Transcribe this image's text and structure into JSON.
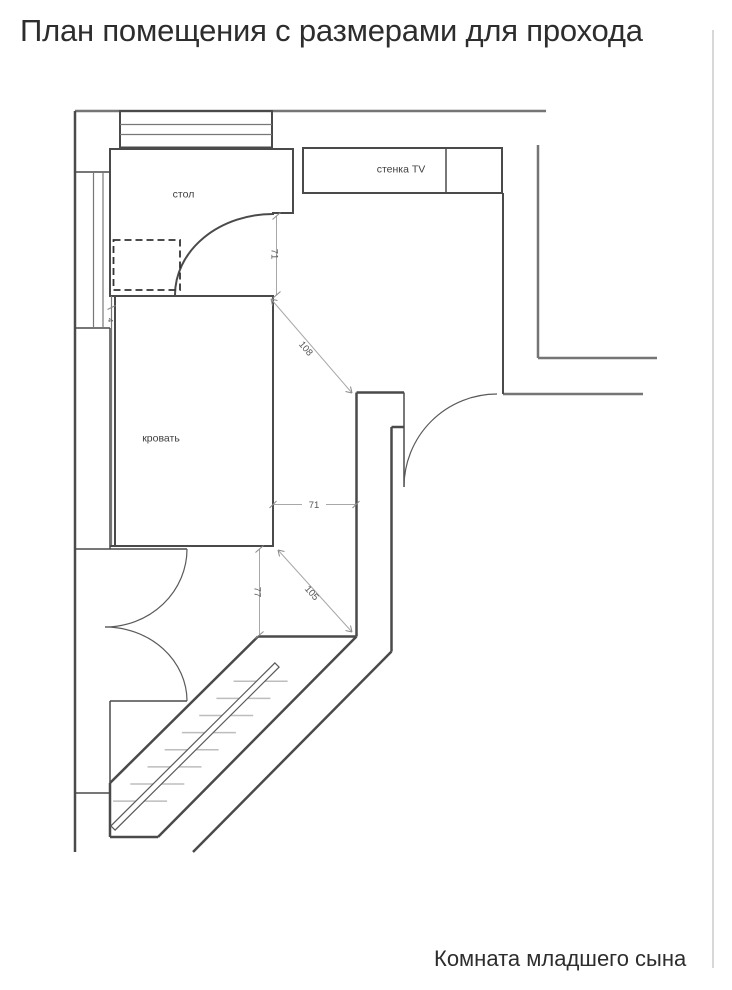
{
  "title": "План помещения с размерами для прохода",
  "caption": "Комната младшего сына",
  "labels": {
    "desk": "стол",
    "tv_unit": "стенка TV",
    "bed": "кровать"
  },
  "dimensions": {
    "desk_to_bed_vertical": "71",
    "bed_corner_to_door_wall_diagonal": "108",
    "bed_to_corridor_wall_horizontal": "71",
    "bed_to_bay_window_vertical": "77",
    "bed_corner_to_corridor_corner_diagonal": "105",
    "bed_to_left_wall_gap": "4"
  },
  "colors": {
    "ink": "#4a4a4a",
    "wall_gray": "#757575",
    "dim_line": "#a8a8a8",
    "dim_text": "#555555",
    "hatch": "#bdbdbd",
    "text_dark": "#2d2d2d",
    "page_border": "#cccccc"
  }
}
